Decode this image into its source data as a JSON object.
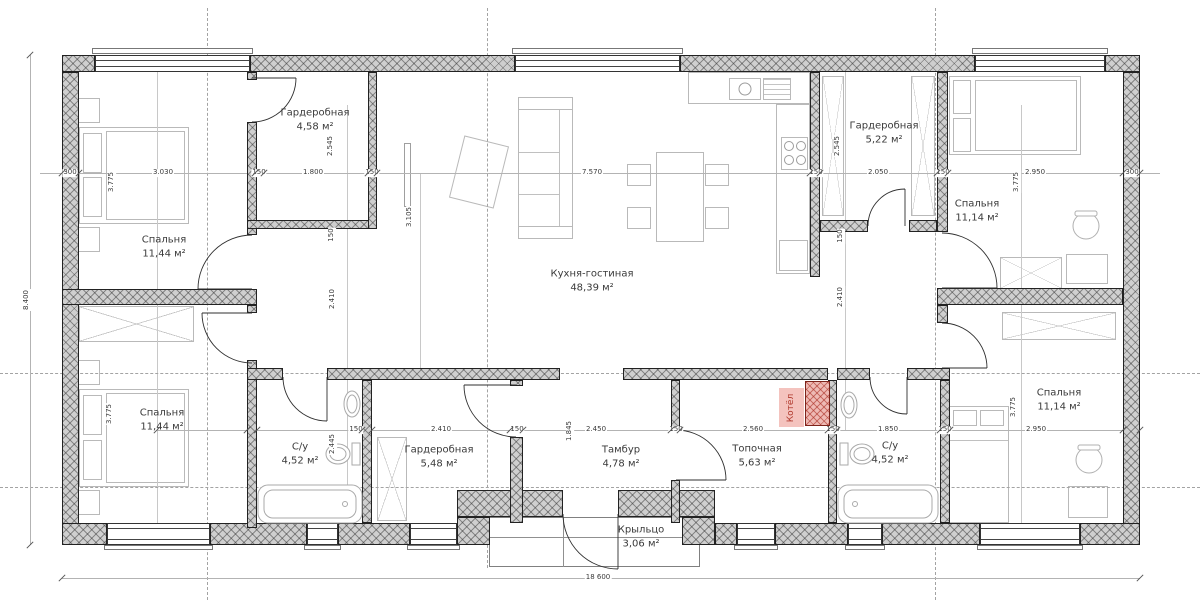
{
  "plan": {
    "rooms": [
      {
        "id": "bedroom-tl",
        "name": "Спальня",
        "area": "11,44 м²"
      },
      {
        "id": "wardrobe-tl",
        "name": "Гардеробная",
        "area": "4,58 м²"
      },
      {
        "id": "kitchen",
        "name": "Кухня-гостиная",
        "area": "48,39 м²"
      },
      {
        "id": "wardrobe-tr",
        "name": "Гардеробная",
        "area": "5,22 м²"
      },
      {
        "id": "bedroom-tr",
        "name": "Спальня",
        "area": "11,14 м²"
      },
      {
        "id": "bedroom-bl",
        "name": "Спальня",
        "area": "11,44 м²"
      },
      {
        "id": "bath-bl",
        "name": "С/у",
        "area": "4,52 м²"
      },
      {
        "id": "wardrobe-bl",
        "name": "Гардеробная",
        "area": "5,48 м²"
      },
      {
        "id": "tambour",
        "name": "Тамбур",
        "area": "4,78 м²"
      },
      {
        "id": "boiler-room",
        "name": "Топочная",
        "area": "5,63 м²"
      },
      {
        "id": "bath-br",
        "name": "С/у",
        "area": "4,52 м²"
      },
      {
        "id": "bedroom-br",
        "name": "Спальня",
        "area": "11,14 м²"
      },
      {
        "id": "porch",
        "name": "Крыльцо",
        "area": "3,06 м²"
      }
    ],
    "boiler": {
      "label": "Котёл"
    },
    "colors": {
      "boiler_fill": "#eebab4",
      "boiler_text": "#b03a2e",
      "wall_fill": "#cfcfcf"
    },
    "dims": {
      "top_row": [
        "300",
        "3.030",
        "150",
        "1.800",
        "150",
        "7.570",
        "150",
        "2.050",
        "150",
        "2.950",
        "300"
      ],
      "bottom_row": [
        "150",
        "2.410",
        "150",
        "2.450",
        "150",
        "2.560",
        "150",
        "1.850",
        "150",
        "2.950"
      ],
      "bedroom_height": "3.775",
      "wardrobe_height": "2.545",
      "corridor_height": "2.410",
      "kitchen_height": "3.105",
      "bath_height": "2.445",
      "tambour_height": "1.845",
      "wall": "150",
      "total_width": "18 600",
      "total_height": "8.400"
    }
  }
}
